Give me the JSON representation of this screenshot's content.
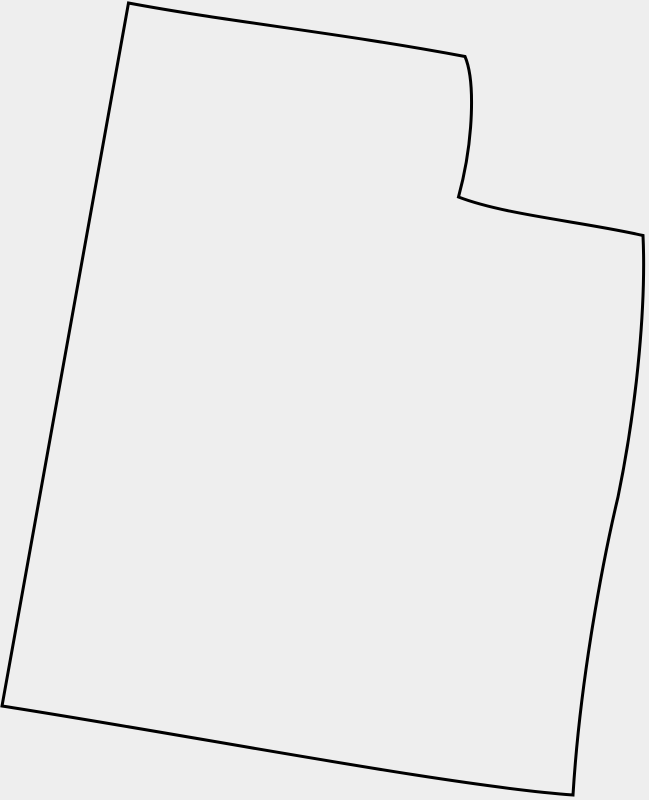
{
  "page": {
    "background_color": "#eeeeee"
  },
  "map": {
    "region": "Utah",
    "stroke_color": "#000000",
    "fill_color": "#eeeeee",
    "stroke_width": "3",
    "path": "M 128.5 3 C 230 22 340 33 465 56.5 C 475 80 474 140 458.5 197 C 505 215 585 222 643 235.5 C 646 300 638 400 618 497 C 603 560 580 680 573 795 C 450 786 200 737 2 706 Z"
  }
}
